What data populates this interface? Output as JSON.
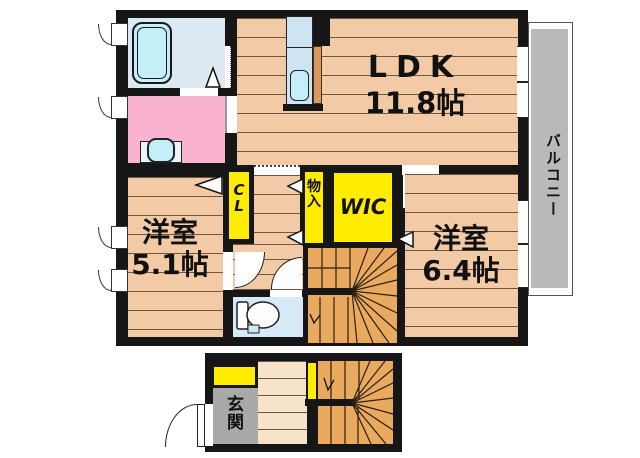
{
  "plan": {
    "rooms": {
      "ldk": {
        "name": "LDK",
        "size": "11.8帖"
      },
      "bedroom_small": {
        "name": "洋室",
        "size": "5.1帖"
      },
      "bedroom_large": {
        "name": "洋室",
        "size": "6.4帖"
      },
      "closet": {
        "label": "CL"
      },
      "storage": {
        "label": "物入"
      },
      "walk_in_closet": {
        "label": "WIC"
      },
      "balcony": {
        "label": "バルコニー"
      },
      "entrance": {
        "label": "玄関"
      }
    }
  },
  "colors": {
    "wall": "#161616",
    "wood_floor": "#f2cba6",
    "floor_line": "#6e573f",
    "hall_floor_1f": "#f6e3ca",
    "stairs": "#e9a95f",
    "bathroom": "#dde9f2",
    "bathtub": "#c4eef8",
    "washroom": "#f9b2d0",
    "toilet_room": "#d6e9f6",
    "kitchen": "#cfe4f2",
    "sink": "#c4eef8",
    "counter": "#d89a62",
    "closet_yellow": "#ffec00",
    "balcony_gray": "#b9b9b9",
    "entrance_gray": "#a9a9a9"
  }
}
